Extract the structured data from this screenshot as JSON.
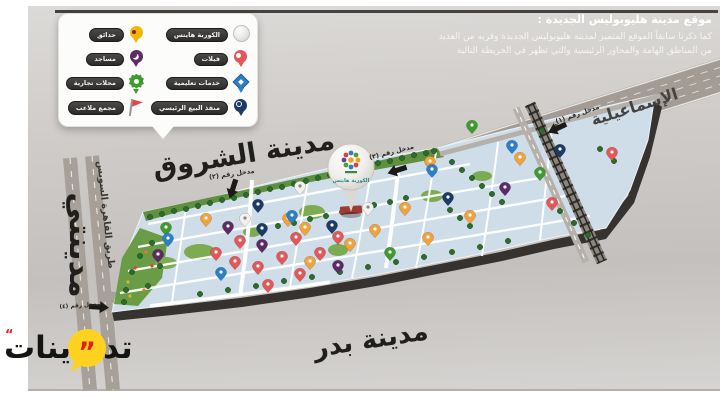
{
  "header": {
    "title": "موقع مدينة هليوبوليس الجديدة :",
    "body_line1": "كما ذكرنا سابقاً الموقع المتميز لمدينة هليوبوليس الجديدة وقربه من العديد",
    "body_line2": "من المناطق الهامة والمحاور الرئيسية والتي تظهر في الخريطة التالية"
  },
  "legend": {
    "right_column": [
      {
        "label": "الكوربة هايتس",
        "icon": "balloon-pin"
      },
      {
        "label": "فيلات",
        "icon": "round-pin-red"
      },
      {
        "label": "خدمات تعليمية",
        "icon": "diamond-pin-blue"
      },
      {
        "label": "منفذ البيع الرئيسي",
        "icon": "target-pin-navy"
      }
    ],
    "left_column": [
      {
        "label": "حدائق",
        "icon": "round-pin-yellow"
      },
      {
        "label": "مساجد",
        "icon": "crescent-pin-purple"
      },
      {
        "label": "محلات تجارية",
        "icon": "burst-pin-green"
      },
      {
        "label": "مجمع ملاعب",
        "icon": "flag-pin-red"
      }
    ]
  },
  "map": {
    "labels": {
      "shorouk": "مدينة الشروق",
      "madinaty": "مدينتي",
      "badr": "مدينة بدر",
      "ismailia": "الإسماعيلية",
      "cairo_suez_road": "طريق القاهرة السويس"
    },
    "entrances": {
      "e1": "مدخل رقم (١)",
      "e2": "مدخل رقم (٢)",
      "e3": "مدخل رقم (٣)",
      "e4": "مدخل رقم (٤)"
    },
    "balloon_text": "الكوربة هايتس",
    "pin_colors": {
      "villas": "#e25757",
      "gardens": "#f0a23c",
      "mosques": "#5d2a66",
      "shops": "#3f9b2f",
      "education": "#2d7fc4",
      "sales_outlet": "#1d3a66"
    }
  },
  "watermark": {
    "text_right": "تد",
    "text_left": "ينات",
    "quote": "”",
    "quote_small": "“"
  }
}
